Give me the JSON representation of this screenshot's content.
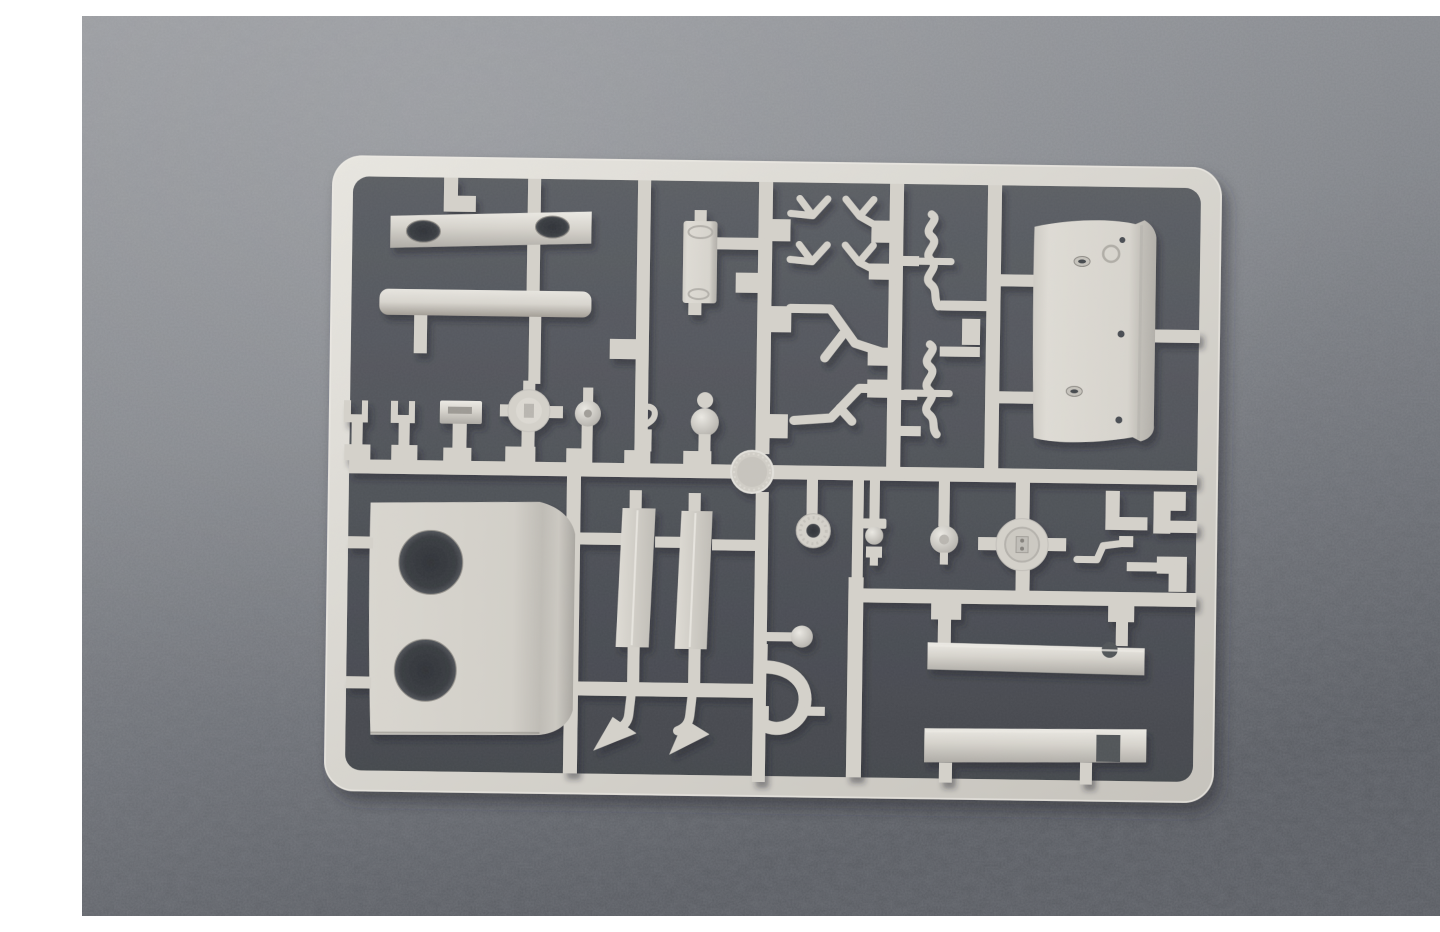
{
  "scene": {
    "type": "photograph",
    "subject": "plastic model kit sprue",
    "description": "Photograph of a light grey injection-molded model-kit sprue (parts tree) lying on a mottled grey fabric backdrop; white paper margins visible on the left and right edges of the photo. The rectangular runner frame holds armor-model parts: plates with holes, curved panels, rods, beams, wheels, hubs, forks, pipes and small fittings. No text is visible.",
    "white_margin_left_px": 42,
    "white_margin_right_px": 38
  },
  "colors": {
    "page_bg": "#ffffff",
    "backdrop_top": "#97999d",
    "backdrop_mid": "#7b7e83",
    "backdrop_bottom": "#585b61",
    "inner_shadow": "#515459",
    "plastic_base": "#d4d1ca",
    "plastic_highlight": "#eceae4",
    "plastic_shadow": "#aeaba5",
    "hole_dark": "#36393e"
  },
  "sprue": {
    "frame": {
      "shape": "rounded rectangle",
      "tilt_deg": 0.8
    },
    "parts": [
      {
        "id": "runner-network",
        "name": "grid of runner bars and connector stubs"
      },
      {
        "id": "bracket-two-oval-holes",
        "name": "flat bracket with two oval openings"
      },
      {
        "id": "round-rod",
        "name": "long cylindrical rod"
      },
      {
        "id": "hinged-box",
        "name": "small rectangular box with hinge collars"
      },
      {
        "id": "y-fork-links",
        "name": "four small Y-shaped fork links"
      },
      {
        "id": "bent-pipes",
        "name": "two bent pipe / handrail pieces"
      },
      {
        "id": "s-curved-rods",
        "name": "two S-curved rods with cross pins"
      },
      {
        "id": "curved-hatch-panel",
        "name": "large curved panel with rivet holes and slots"
      },
      {
        "id": "plate-two-holes",
        "name": "large plate with two big round openings"
      },
      {
        "id": "tread-strips",
        "name": "two narrow tread strips"
      },
      {
        "id": "arrow-brackets",
        "name": "two bent brackets with arrow-shaped feet"
      },
      {
        "id": "tow-shackle",
        "name": "horseshoe shackle with ball pin"
      },
      {
        "id": "clevis-forks",
        "name": "two small clevis forks"
      },
      {
        "id": "slotted-paddle",
        "name": "slotted paddle fitting"
      },
      {
        "id": "four-stub-hub",
        "name": "round hub with four stub axles"
      },
      {
        "id": "small-wheel",
        "name": "small wheel on post"
      },
      {
        "id": "s-hook",
        "name": "small S-hook fitting"
      },
      {
        "id": "ball-post",
        "name": "ball-topped post"
      },
      {
        "id": "textured-disc",
        "name": "round textured disc at runner junction"
      },
      {
        "id": "flanged-ring",
        "name": "flanged ring with center hole"
      },
      {
        "id": "valve-fitting",
        "name": "small valve fitting"
      },
      {
        "id": "small-round-hub",
        "name": "small round hub"
      },
      {
        "id": "cross-axle-wheel",
        "name": "wheel hub with cross axles"
      },
      {
        "id": "bent-crank",
        "name": "bent crank rod"
      },
      {
        "id": "step-brackets",
        "name": "three stepped mounting brackets"
      },
      {
        "id": "beam-upper",
        "name": "long beam with circular notch"
      },
      {
        "id": "beam-lower",
        "name": "long channel beam with square notch"
      }
    ]
  }
}
